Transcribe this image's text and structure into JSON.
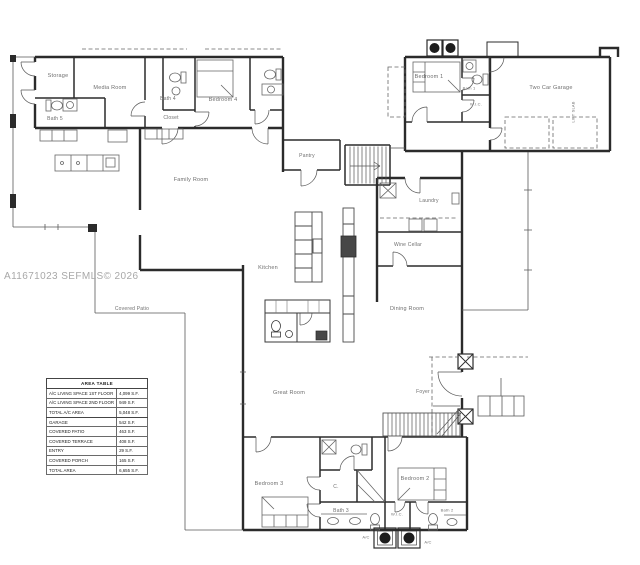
{
  "watermark": "A11671023 SEFMLS© 2026",
  "rooms": [
    {
      "id": "storage",
      "label": "Storage"
    },
    {
      "id": "media-room",
      "label": "Media Room"
    },
    {
      "id": "bath-5",
      "label": "Bath 5"
    },
    {
      "id": "bath-4",
      "label": "Bath 4"
    },
    {
      "id": "closet",
      "label": "Closet"
    },
    {
      "id": "bedroom-4",
      "label": "Bedroom 4"
    },
    {
      "id": "family-room",
      "label": "Family Room"
    },
    {
      "id": "pantry",
      "label": "Pantry"
    },
    {
      "id": "kitchen",
      "label": "Kitchen"
    },
    {
      "id": "laundry",
      "label": "Laundry"
    },
    {
      "id": "wine-cellar",
      "label": "Wine Cellar"
    },
    {
      "id": "dining-room",
      "label": "Dining Room"
    },
    {
      "id": "great-room",
      "label": "Great Room"
    },
    {
      "id": "foyer",
      "label": "Foyer"
    },
    {
      "id": "covered-patio",
      "label": "Covered Patio"
    },
    {
      "id": "bedroom-3",
      "label": "Bedroom 3"
    },
    {
      "id": "closet-c",
      "label": "C."
    },
    {
      "id": "bath-3",
      "label": "Bath 3"
    },
    {
      "id": "bedroom-2",
      "label": "Bedroom 2"
    },
    {
      "id": "wic-2",
      "label": "W.I.C."
    },
    {
      "id": "bath-2",
      "label": "Bath 2"
    },
    {
      "id": "bedroom-1",
      "label": "Bedroom 1"
    },
    {
      "id": "bath-1",
      "label": "Bath 1"
    },
    {
      "id": "wic-1",
      "label": "W.I.C."
    },
    {
      "id": "garage",
      "label": "Two Car Garage"
    },
    {
      "id": "lift-note",
      "label": "LIFT SLAB"
    },
    {
      "id": "ac-1",
      "label": "A/C"
    },
    {
      "id": "ac-2",
      "label": "A/C"
    }
  ],
  "area_table": {
    "title": "AREA TABLE",
    "rows": [
      {
        "name": "A/C LIVING SPACE 1ST FLOOR",
        "value": "4,099 S.F."
      },
      {
        "name": "A/C LIVING SPACE 2ND FLOOR",
        "value": "949 S.F."
      },
      {
        "name": "TOTAL A/C AREA",
        "value": "5,048 S.F."
      },
      {
        "name": "GARAGE",
        "value": "542 S.F."
      },
      {
        "name": "COVERED PATIO",
        "value": "463 S.F."
      },
      {
        "name": "COVERED TERRACE",
        "value": "408 S.F."
      },
      {
        "name": "ENTRY",
        "value": "29 S.F."
      },
      {
        "name": "COVERED PORCH",
        "value": "165 S.F."
      },
      {
        "name": "TOTAL AREA",
        "value": "6,655 S.F."
      }
    ]
  },
  "colors": {
    "ink": "#2b2b2b",
    "label_text": "#6e6e6e",
    "watermark_text": "#a8a8a8"
  }
}
